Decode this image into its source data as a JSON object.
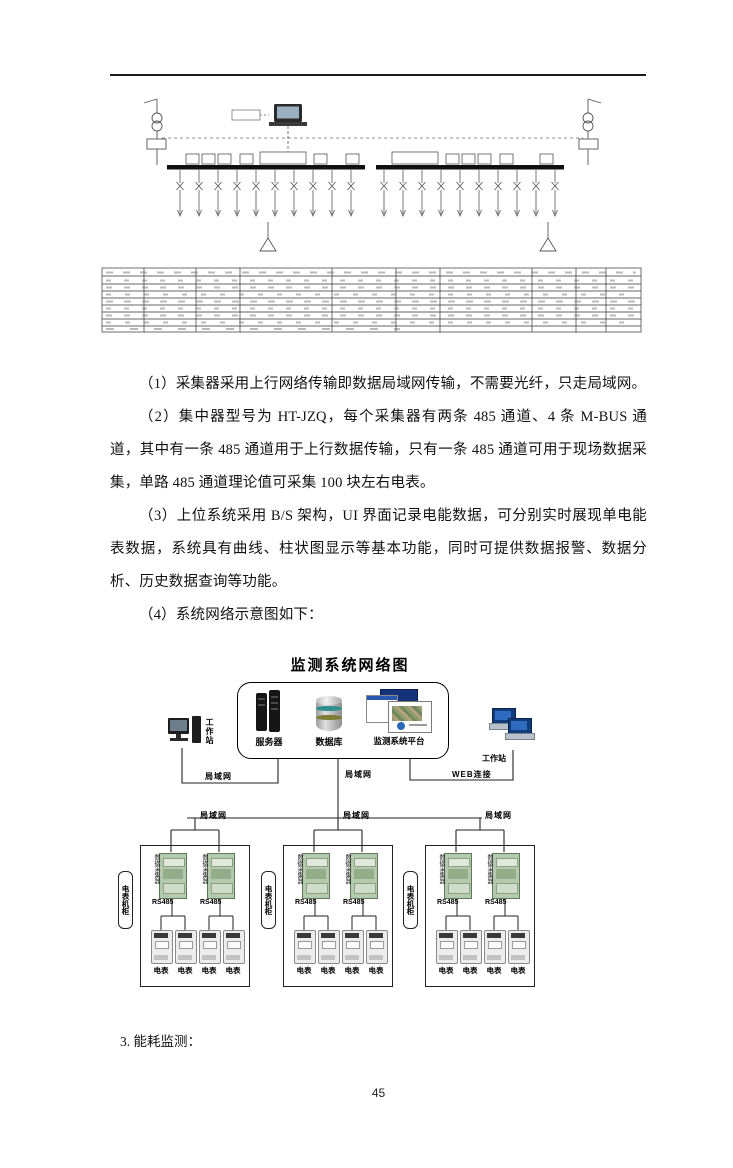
{
  "paragraphs": [
    {
      "text": "（1）采集器采用上行网络传输即数据局域网传输，不需要光纤，只走局域网。"
    },
    {
      "text": "（2）集中器型号为 HT-JZQ，每个采集器有两条 485 通道、4 条 M-BUS 通道，其中有一条 485 通道用于上行数据传输，只有一条 485 通道可用于现场数据采集，单路 485 通道理论值可采集 100 块左右电表。"
    },
    {
      "text": "（3）上位系统采用 B/S 架构，UI 界面记录电能数据，可分别实时展现单电能表数据，系统具有曲线、柱状图显示等基本功能，同时可提供数据报警、数据分析、历史数据查询等功能。"
    },
    {
      "text": "（4）系统网络示意图如下："
    }
  ],
  "network": {
    "title": "监测系统网络图",
    "nodes": {
      "server": "服务器",
      "database": "数据库",
      "platform": "监测系统平台",
      "workstation_left": "工作站",
      "workstation_right": "工作站"
    },
    "links": {
      "lan": "局域网",
      "web": "WEB连接"
    },
    "branch": {
      "cabinet": "电表机柜",
      "collector": "数据采集器",
      "channel": "RS485",
      "meter": "电表"
    }
  },
  "section_heading": "3. 能耗监测：",
  "page_number": "45"
}
